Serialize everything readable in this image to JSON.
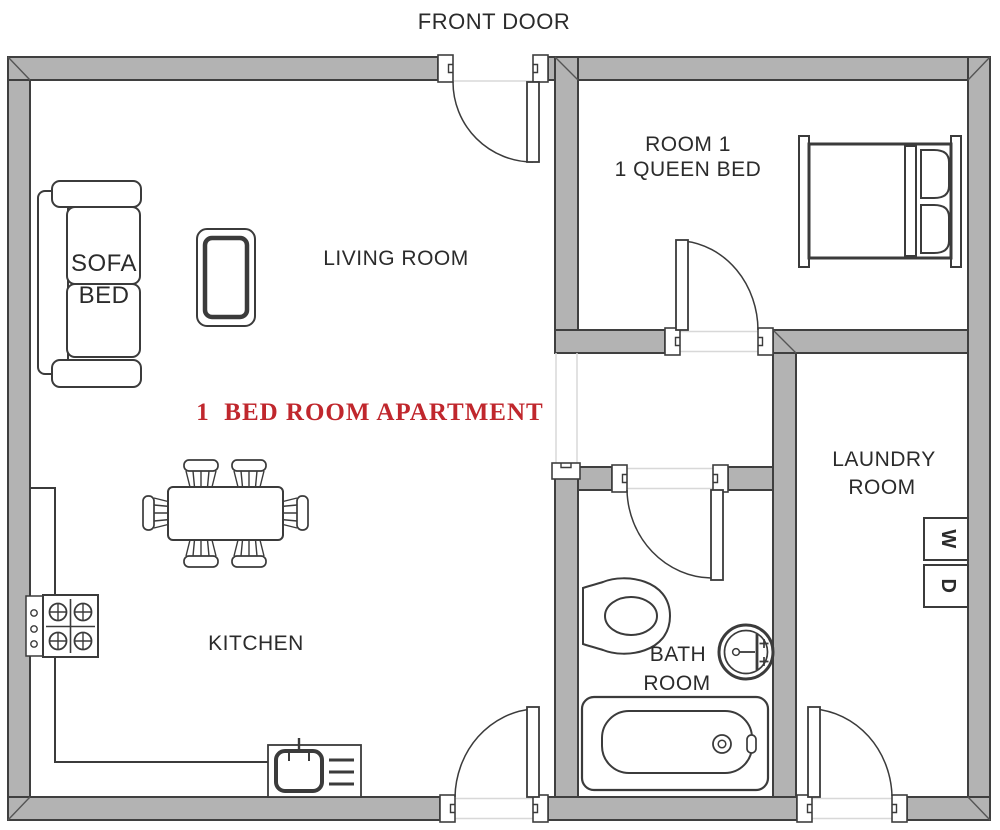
{
  "plan_title": {
    "text": "1  BED ROOM APARTMENT",
    "color": "#c0272d"
  },
  "labels": {
    "front_door": "FRONT DOOR",
    "living_room": "LIVING ROOM",
    "kitchen": "KITCHEN",
    "room1_line1": "ROOM 1",
    "room1_line2": "1 QUEEN BED",
    "bathroom_line1": "BATH",
    "bathroom_line2": "ROOM",
    "laundry_line1": "LAUNDRY",
    "laundry_line2": "ROOM",
    "sofa_line1": "SOFA",
    "sofa_line2": "BED",
    "washer": "W",
    "dryer": "D"
  },
  "colors": {
    "wall_fill": "#b3b3b3",
    "wall_stroke": "#3f3f3f",
    "line": "#3b3b3b",
    "title_red": "#c0272d",
    "background": "#ffffff"
  }
}
